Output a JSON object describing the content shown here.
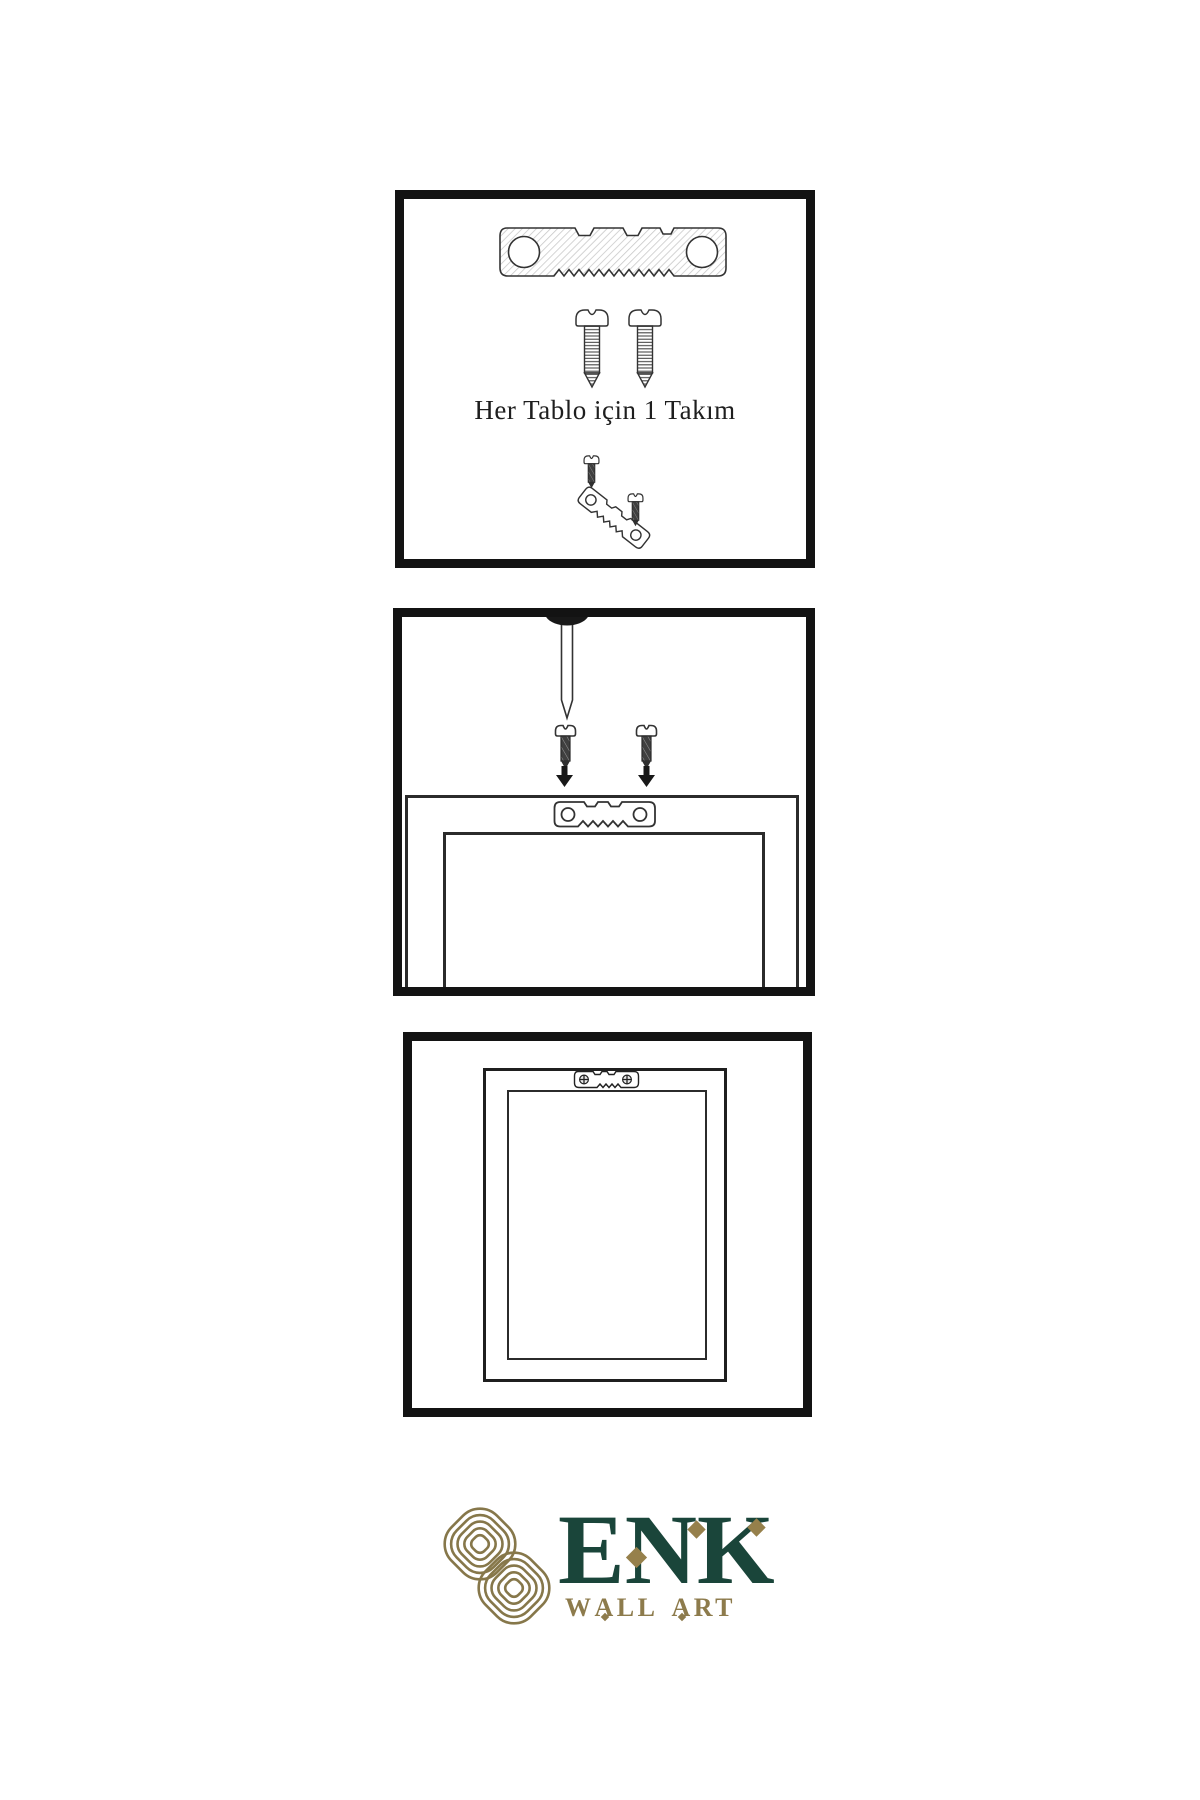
{
  "canvas": {
    "background": "#ffffff"
  },
  "colors": {
    "panel_border": "#131313",
    "illustration_line": "#333333",
    "dark_metal": "#3d3d3d",
    "brand_green": "#1a453a",
    "brand_gold": "#96804b",
    "knot_gold": "#86774a",
    "caption_text": "#1e1e1e"
  },
  "steps": [
    {
      "caption": "Her Tablo için 1 Takım",
      "items": [
        "sawtooth-hanger",
        "screw",
        "screw",
        "mounting-screw",
        "angled-sawtooth-hanger",
        "mounting-screw"
      ]
    },
    {
      "items": [
        "wall-nail",
        "mounting-screw",
        "mounting-screw",
        "down-arrow",
        "down-arrow",
        "frame-back-with-sawtooth-plate"
      ]
    },
    {
      "items": [
        "picture-frame-back-with-mounted-sawtooth-plate"
      ]
    }
  ],
  "logo": {
    "wordmark": "ENK",
    "subtitle_p1": "W",
    "subtitle_a1": "A",
    "subtitle_p2": "LL",
    "subtitle_a2": "A",
    "subtitle_p3": "RT"
  }
}
